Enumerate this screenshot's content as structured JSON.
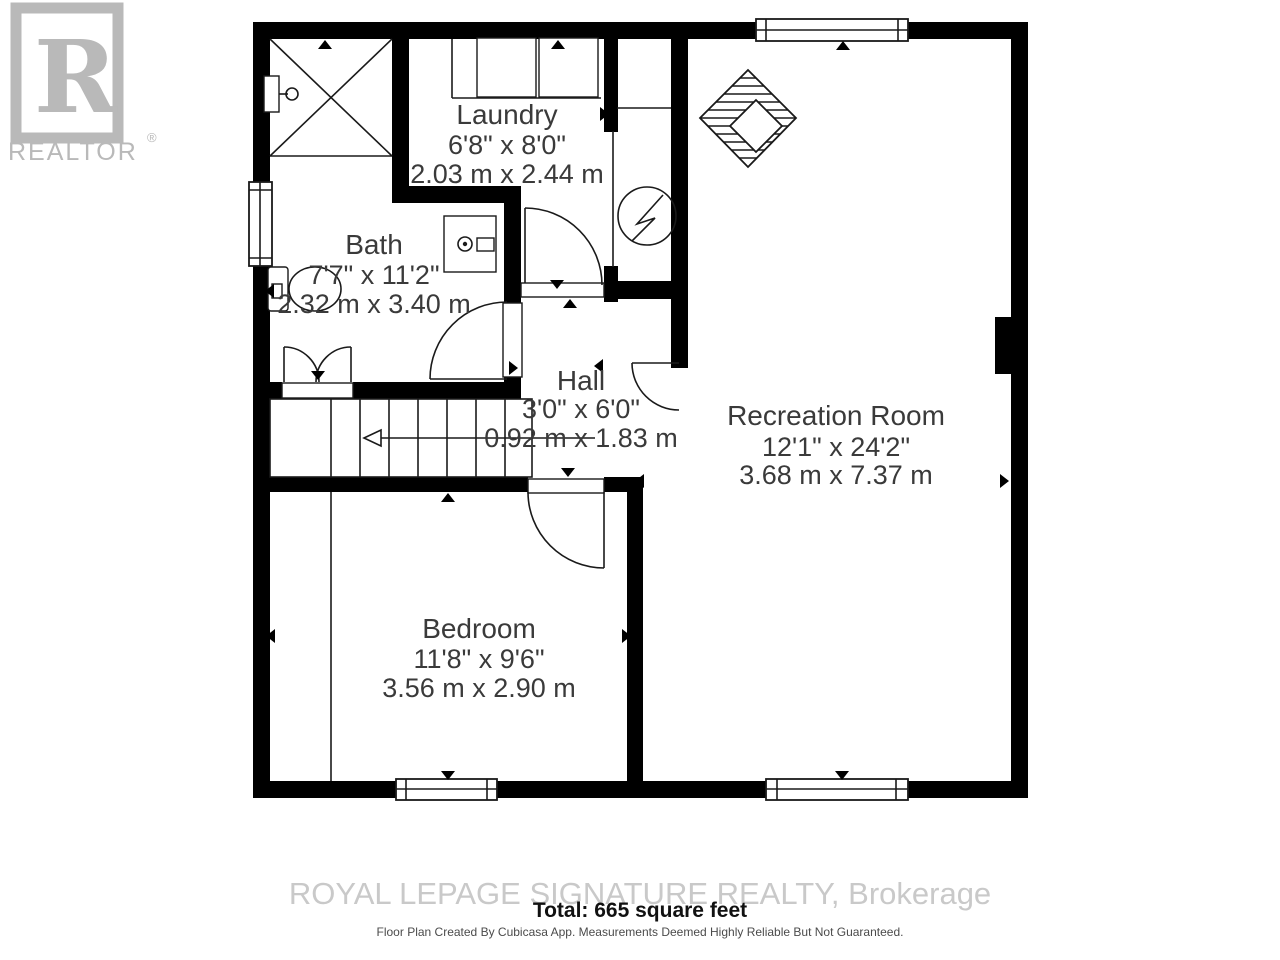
{
  "branding": {
    "logo_letter": "R",
    "logo_text": "REALTOR",
    "registered": "®"
  },
  "rooms": {
    "laundry": {
      "name": "Laundry",
      "imperial": "6'8\" x 8'0\"",
      "metric": "2.03 m x 2.44 m"
    },
    "bath": {
      "name": "Bath",
      "imperial": "7'7\" x 11'2\"",
      "metric": "2.32 m x 3.40 m"
    },
    "hall": {
      "name": "Hall",
      "imperial": "3'0\" x 6'0\"",
      "metric": "0.92 m x 1.83 m"
    },
    "recreation": {
      "name": "Recreation Room",
      "imperial": "12'1\" x 24'2\"",
      "metric": "3.68 m x 7.37 m"
    },
    "bedroom": {
      "name": "Bedroom",
      "imperial": "11'8\" x 9'6\"",
      "metric": "3.56 m x 2.90 m"
    }
  },
  "footer": {
    "watermark": "ROYAL LEPAGE SIGNATURE REALTY, Brokerage",
    "total": "Total: 665 square feet",
    "disclaimer": "Floor Plan Created By Cubicasa App. Measurements Deemed Highly Reliable But Not Guaranteed."
  },
  "colors": {
    "wall": "#000000",
    "label_text": "#3a3a3a",
    "watermark_gray": "#c9c9c9",
    "logo_gray": "#b9b9b9"
  }
}
